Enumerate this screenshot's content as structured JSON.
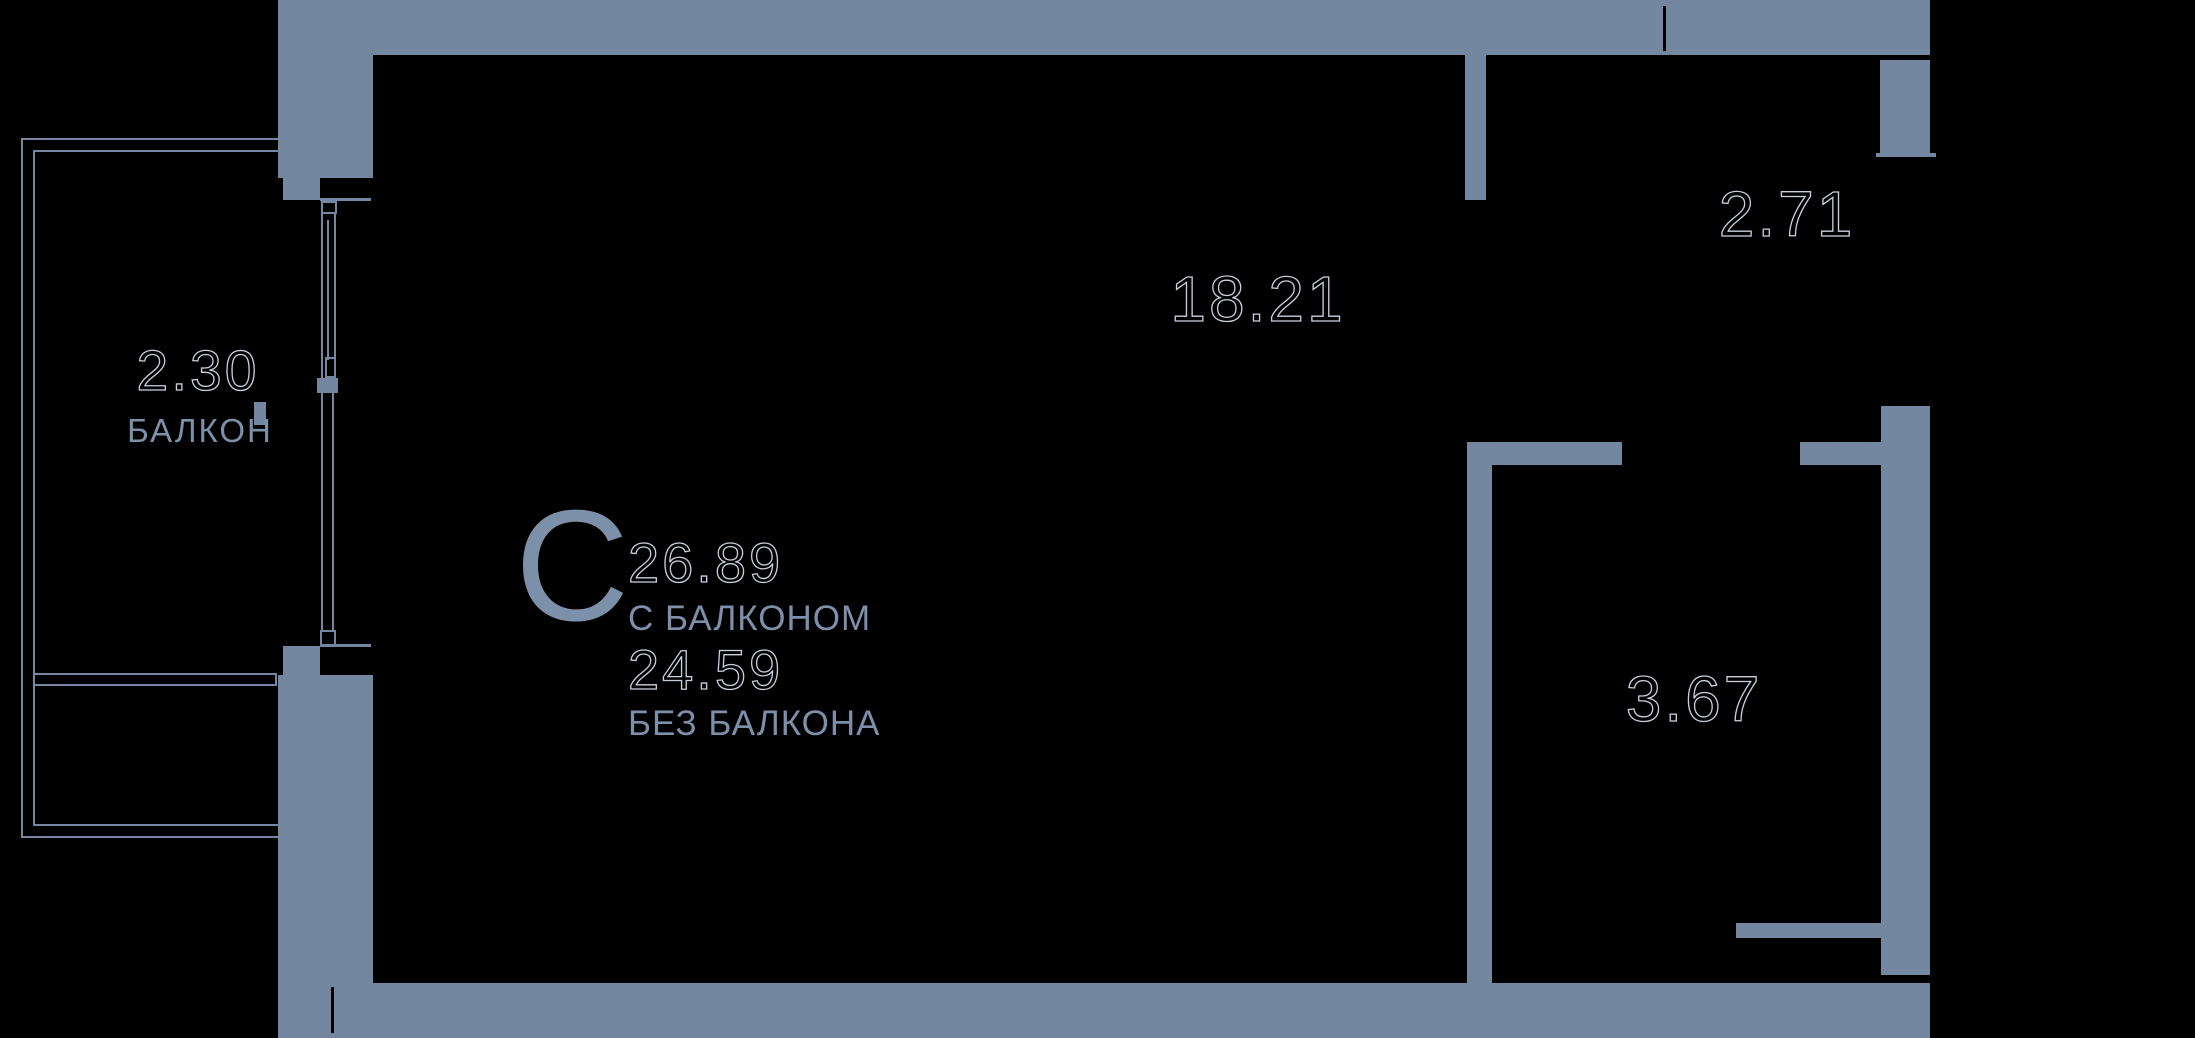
{
  "plan": {
    "type_letter": "С",
    "area_with_balcony": "26.89",
    "with_balcony_label": "С БАЛКОНОМ",
    "area_without_balcony": "24.59",
    "without_balcony_label": "БЕЗ БАЛКОНА",
    "rooms": [
      {
        "id": "main-room",
        "area": "18.21"
      },
      {
        "id": "entry-niche",
        "area": "2.71"
      },
      {
        "id": "bathroom",
        "area": "3.67"
      },
      {
        "id": "balcony",
        "area": "2.30",
        "label": "БАЛКОН"
      }
    ],
    "colors": {
      "background": "#000000",
      "wall": "#7487A1",
      "label_text": "#7D90AA",
      "number_outline": "#C7D1DB"
    }
  }
}
